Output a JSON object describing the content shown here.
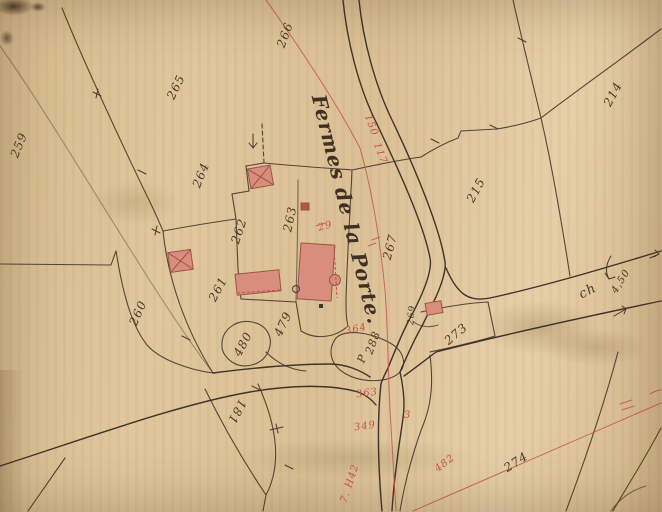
{
  "map": {
    "title": "Fermes de la Porte.",
    "ink_labels": [
      {
        "text": "259"
      },
      {
        "text": "265"
      },
      {
        "text": "266"
      },
      {
        "text": "264"
      },
      {
        "text": "262"
      },
      {
        "text": "263"
      },
      {
        "text": "267"
      },
      {
        "text": "215"
      },
      {
        "text": "214"
      },
      {
        "text": "260"
      },
      {
        "text": "261"
      },
      {
        "text": "479"
      },
      {
        "text": "480"
      },
      {
        "text": "181"
      },
      {
        "text": "273"
      },
      {
        "text": "269"
      },
      {
        "text": "288"
      },
      {
        "text": "P"
      },
      {
        "text": "274"
      },
      {
        "text": "ch"
      },
      {
        "text": "4,50"
      }
    ],
    "red_labels": [
      {
        "text": "150"
      },
      {
        "text": "117"
      },
      {
        "text": "29"
      },
      {
        "text": "364"
      },
      {
        "text": "363"
      },
      {
        "text": "349"
      },
      {
        "text": "3"
      },
      {
        "text": "482"
      },
      {
        "text": "7. H42"
      }
    ],
    "colors": {
      "paper": "#ddc298",
      "ink": "#4a3b2c",
      "red_ink": "#c4564a",
      "building_fill": "#d98d7d",
      "building_stroke": "#9c5347"
    }
  }
}
